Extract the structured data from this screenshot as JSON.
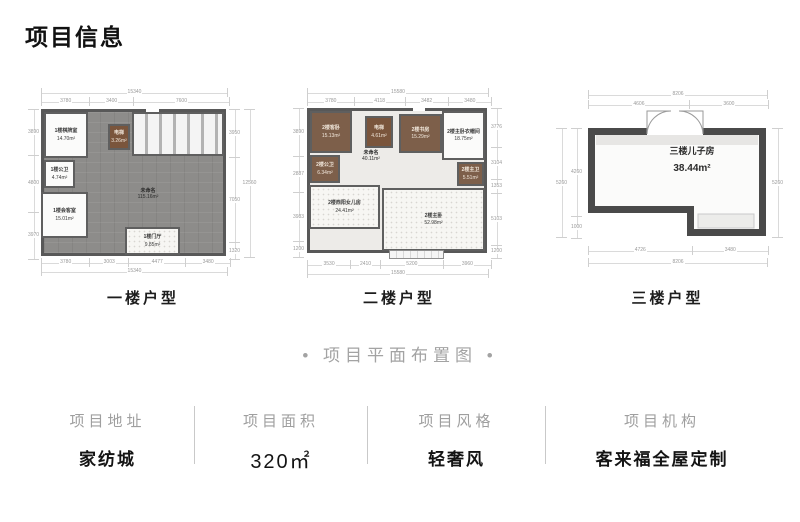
{
  "page": {
    "title": "项目信息",
    "subtitle": "• 项目平面布置图 •"
  },
  "plans": [
    {
      "caption": "一楼户型",
      "rooms": {
        "qipai": {
          "name": "1楼棋牌室",
          "area": "14.70m²"
        },
        "elevator": {
          "name": "电梯",
          "area": "3.26m²"
        },
        "gongwei": {
          "name": "1楼公卫",
          "area": "4.74m²"
        },
        "huike": {
          "name": "1楼会客室",
          "area": "15.01m²"
        },
        "unnamed": {
          "name": "未命名",
          "area": "115.16m²"
        },
        "menting": {
          "name": "1楼门厅",
          "area": "9.85m²"
        }
      },
      "dims": {
        "top_total": "15340",
        "top": [
          "3780",
          "3400",
          "7600"
        ],
        "left": [
          "3890",
          "4800",
          "3970"
        ],
        "right": [
          "3950",
          "7050",
          "1320"
        ],
        "right_total": "12560",
        "bottom": [
          "3780",
          "3003",
          "4477",
          "3480"
        ],
        "bottom_total": "15340"
      }
    },
    {
      "caption": "二楼户型",
      "rooms": {
        "kewo": {
          "name": "2楼客卧",
          "area": "15.13m²"
        },
        "elevator": {
          "name": "电梯",
          "area": "4.61m²"
        },
        "unnamed": {
          "name": "未命名",
          "area": "40.11m²"
        },
        "shufang": {
          "name": "2楼书房",
          "area": "15.29m²"
        },
        "yimaojian": {
          "name": "2楼主卧衣帽间",
          "area": "18.75m²"
        },
        "gongwei": {
          "name": "2楼公卫",
          "area": "6.34m²"
        },
        "zhuwei": {
          "name": "2楼主卫",
          "area": "5.51m²"
        },
        "nverfang": {
          "name": "2楼西阳女儿房",
          "area": "24.41m²"
        },
        "zhuwo": {
          "name": "2楼主卧",
          "area": "52.98m²"
        }
      },
      "dims": {
        "top_total": "15580",
        "top": [
          "3780",
          "4118",
          "3482",
          "3480"
        ],
        "left": [
          "3890",
          "2887",
          "3983",
          "1200"
        ],
        "right": [
          "3776",
          "3104",
          "1353",
          "5103",
          "1200"
        ],
        "bottom": [
          "3530",
          "2410",
          "5200",
          "3960"
        ],
        "bottom_total": "15580"
      }
    },
    {
      "caption": "三楼户型",
      "rooms": {
        "erzifang": {
          "name": "三楼儿子房",
          "area": "38.44m²"
        }
      },
      "dims": {
        "top_total": "8206",
        "top": [
          "4606",
          "3600"
        ],
        "left": [
          "4260",
          "1000"
        ],
        "left_total": "5260",
        "right_total": "5260",
        "bottom": [
          "4726",
          "3480"
        ],
        "bottom_total": "8206"
      }
    }
  ],
  "info": {
    "items": [
      {
        "label": "项目地址",
        "value": "家纺城"
      },
      {
        "label": "项目面积",
        "value": "320㎡"
      },
      {
        "label": "项目风格",
        "value": "轻奢风"
      },
      {
        "label": "项目机构",
        "value": "客来福全屋定制"
      }
    ]
  }
}
